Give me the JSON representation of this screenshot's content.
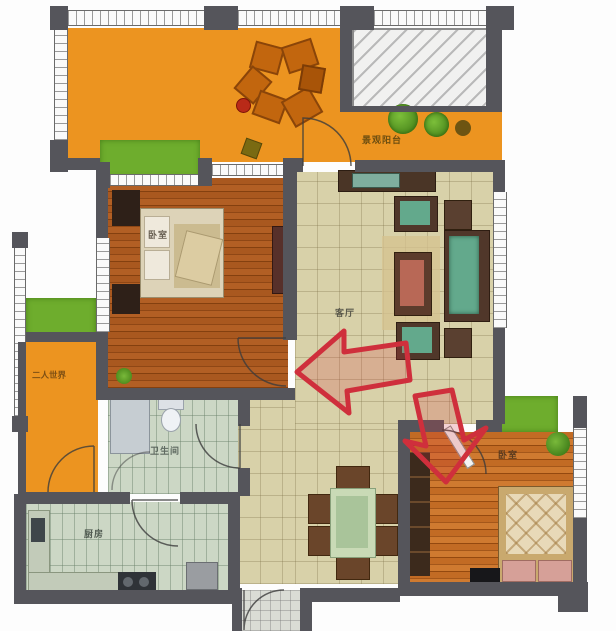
{
  "figure_type": "apartment-floor-plan",
  "rooms": {
    "balcony_top": {
      "label": "景观阳台"
    },
    "bedroom_left": {
      "label": "卧室"
    },
    "living_room": {
      "label": "客厅"
    },
    "balcony_left": {
      "label": "二人世界"
    },
    "bathroom": {
      "label": "卫生间"
    },
    "kitchen": {
      "label": "厨房"
    },
    "bedroom_right": {
      "label": "卧室"
    }
  },
  "annotations": {
    "arrows": [
      {
        "name": "red-arrow-pointing-left-into-living-room"
      },
      {
        "name": "red-arrow-pointing-down-into-right-bedroom-door"
      }
    ]
  },
  "palette": {
    "wall": "#55555b",
    "balcony_orange": "#ec9420",
    "grass_green": "#6ead2d",
    "living_tile": "#d8d1a9",
    "wet_room_tile": "#ccd7c5",
    "wood_floor_left": "#a9581f",
    "wood_floor_right": "#c26b24",
    "sofa_green": "#63a98c",
    "arrow_red": "#cf2f3c"
  }
}
